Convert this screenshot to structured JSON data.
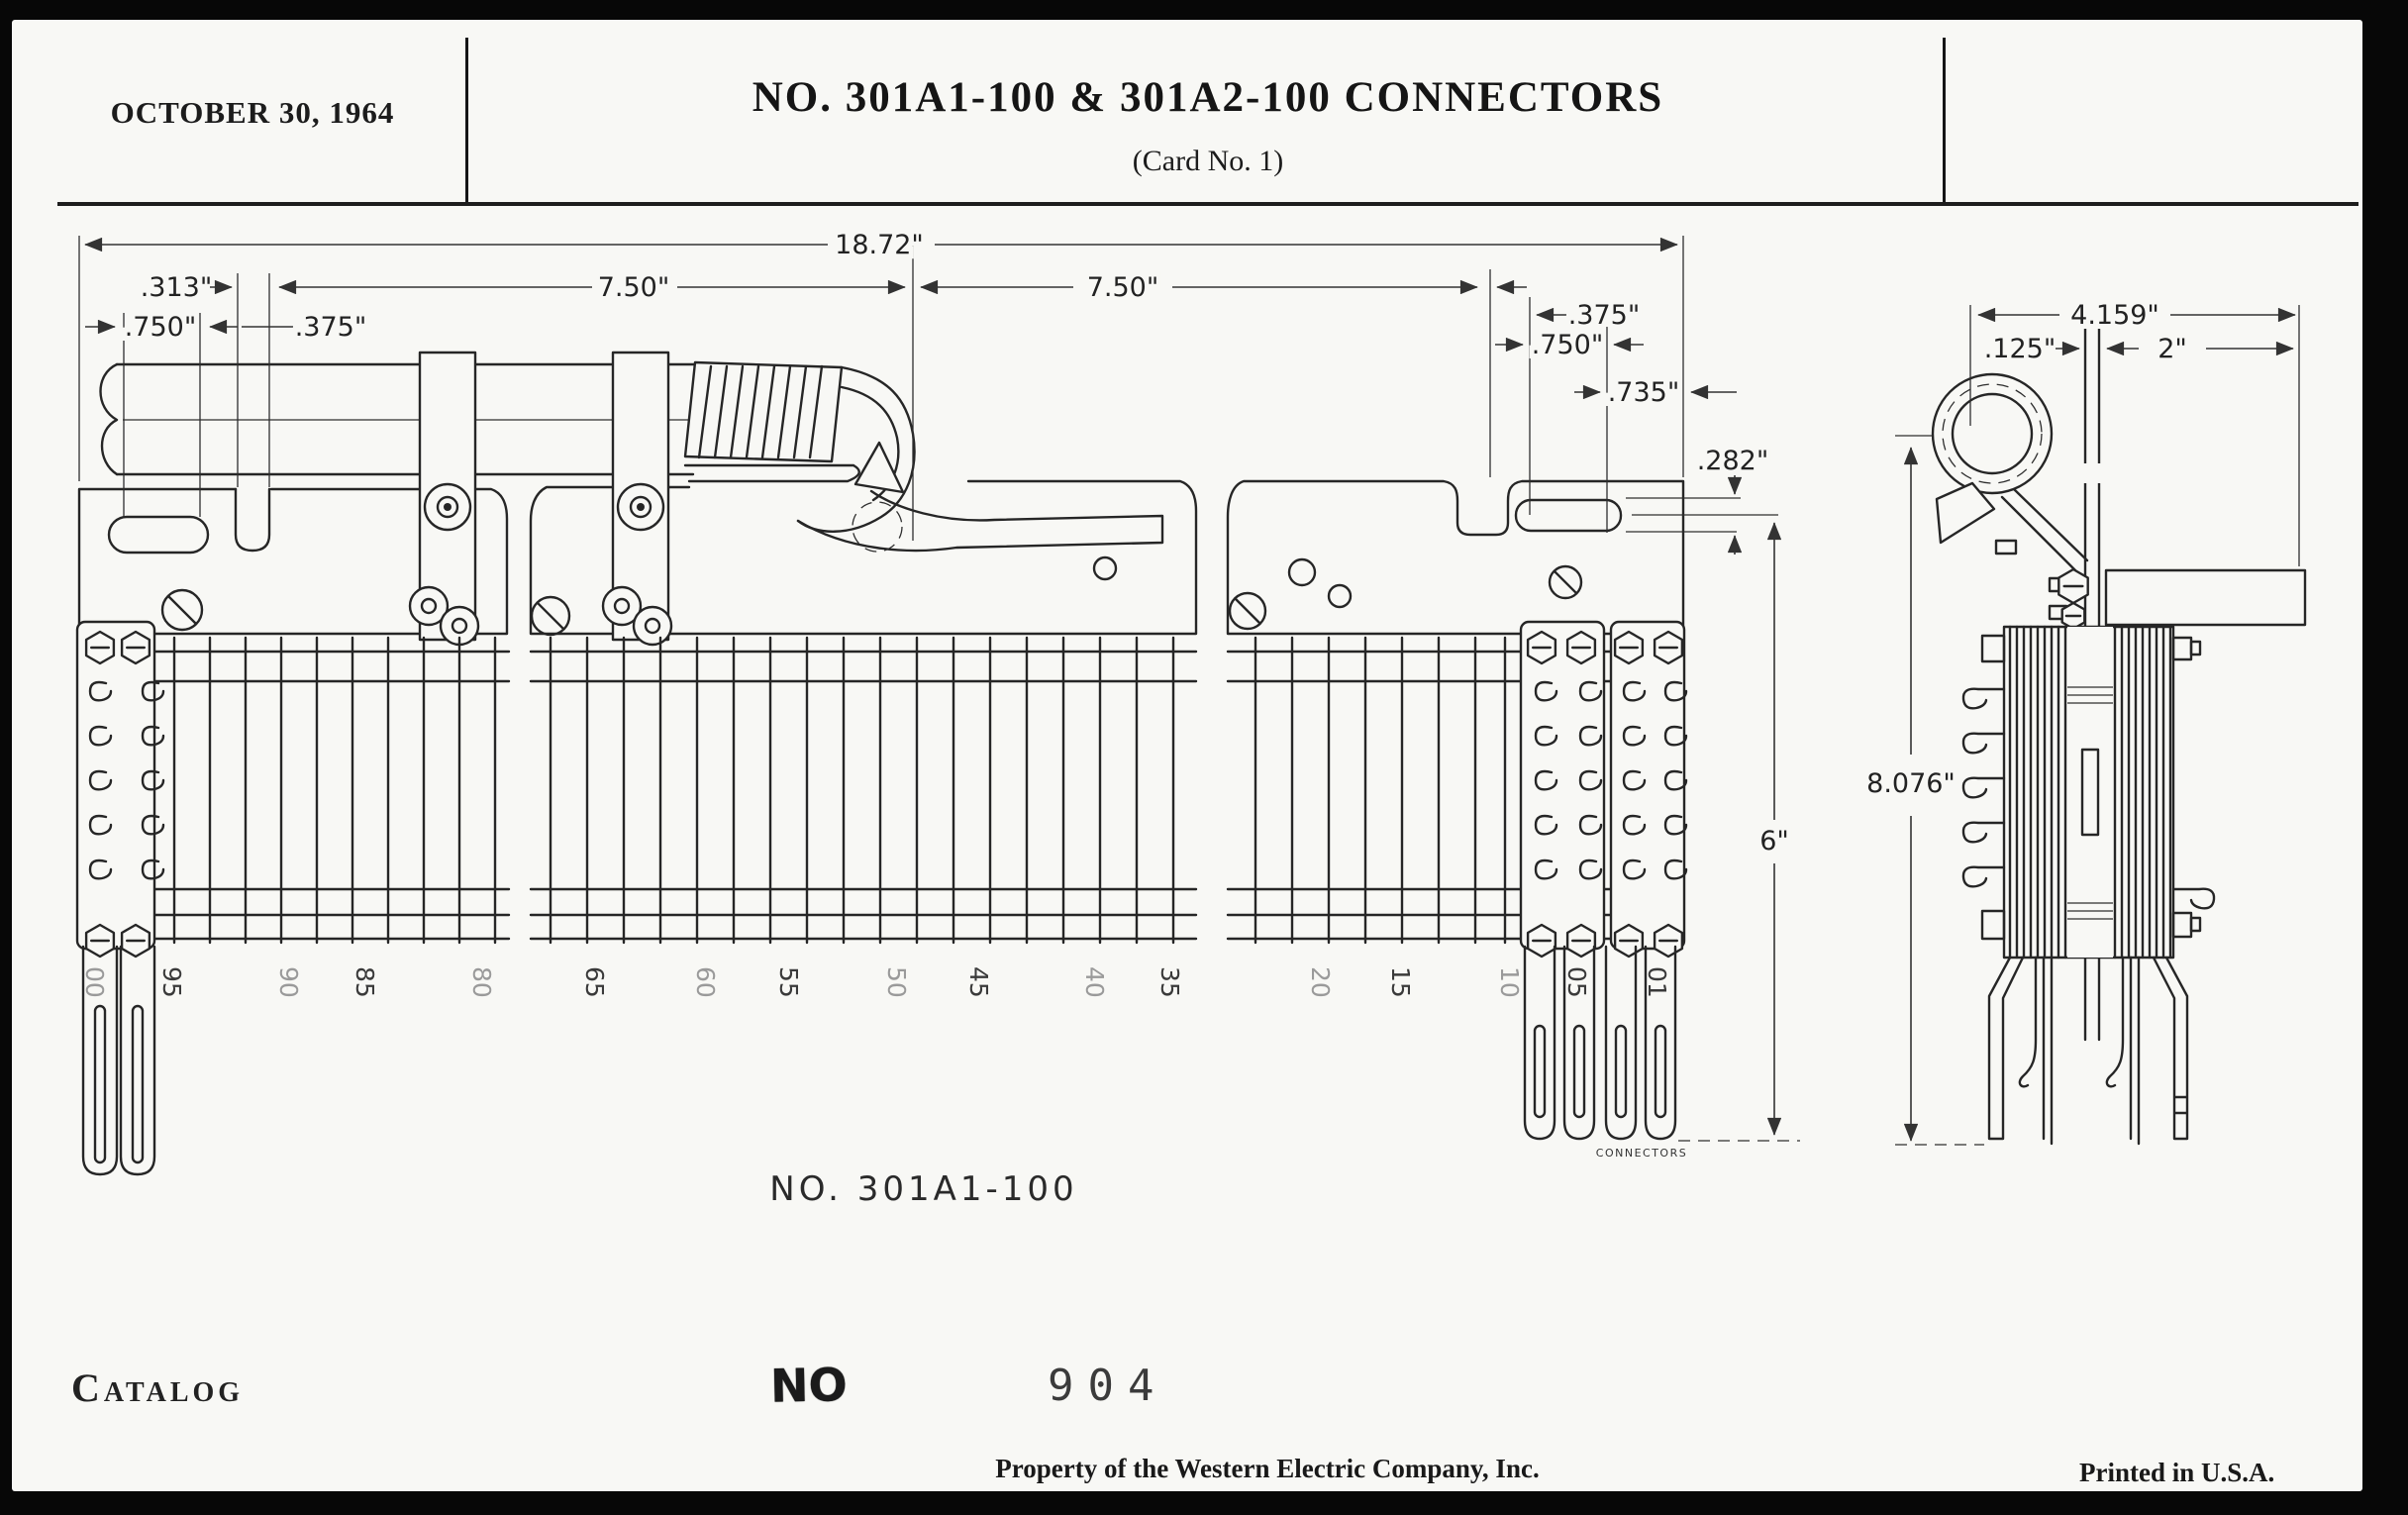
{
  "header": {
    "date": "OCTOBER 30, 1964",
    "title": "NO. 301A1-100 & 301A2-100 CONNECTORS",
    "subtitle": "(Card No. 1)"
  },
  "drawing": {
    "front": {
      "caption": "NO. 301A1-100",
      "connectors_label": "CONNECTORS",
      "dims": {
        "overall": "18.72\"",
        "gap_313": ".313\"",
        "offset_750_left": ".750\"",
        "gap_375_left": ".375\"",
        "span_left": "7.50\"",
        "span_right": "7.50\"",
        "gap_375_right": ".375\"",
        "offset_750_right": ".750\"",
        "offset_735": ".735\"",
        "slot_282": ".282\"",
        "height_6": "6\""
      },
      "terminal_numbers": [
        "00",
        "95",
        "90",
        "85",
        "80",
        "65",
        "60",
        "55",
        "50",
        "45",
        "40",
        "35",
        "20",
        "15",
        "10",
        "05",
        "01"
      ]
    },
    "side": {
      "dims": {
        "overall_width": "4.159\"",
        "bar_thickness": ".125\"",
        "offset_2": "2\"",
        "overall_height": "8.076\""
      }
    }
  },
  "catalog": {
    "label": "Catalog",
    "no_stamp": "NO",
    "number": "904"
  },
  "footer": {
    "property_line": "Property of the Western Electric Company, Inc.",
    "printed_line": "Printed in U.S.A."
  }
}
